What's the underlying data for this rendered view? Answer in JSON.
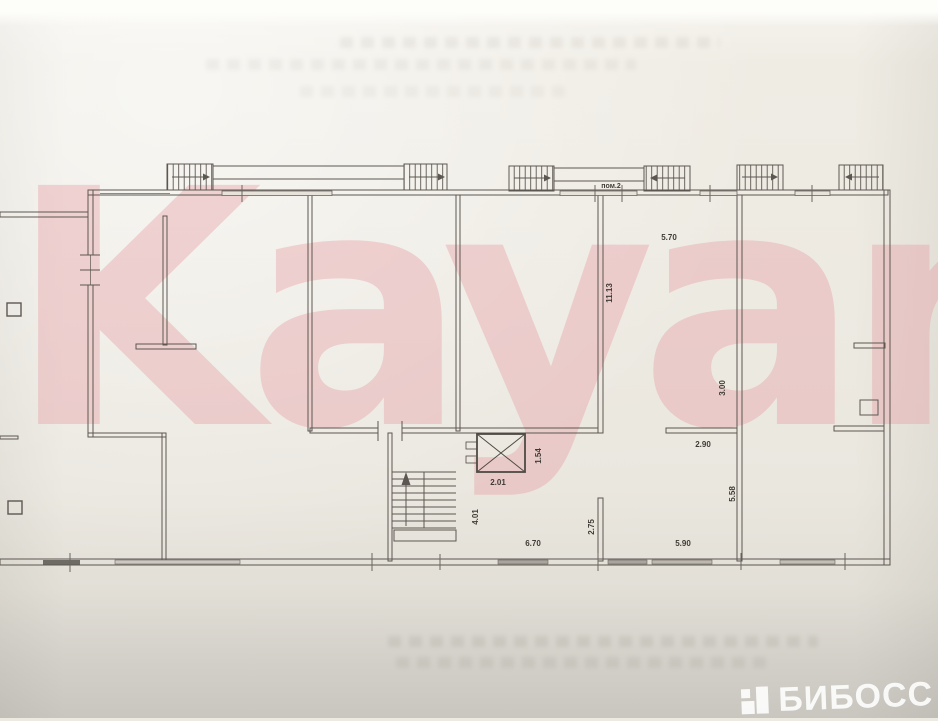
{
  "watermark": {
    "text": "Kayan"
  },
  "brand": {
    "name": "БИБОСС"
  },
  "plan": {
    "room_label": "пом.2",
    "dimensions": [
      {
        "text": "5.70"
      },
      {
        "text": "11.13"
      },
      {
        "text": "3.00"
      },
      {
        "text": "2.90"
      },
      {
        "text": "5.58"
      },
      {
        "text": "1.54"
      },
      {
        "text": "2.01"
      },
      {
        "text": "4.01"
      },
      {
        "text": "6.70"
      },
      {
        "text": "2.75"
      },
      {
        "text": "5.90"
      }
    ],
    "colors": {
      "line": "#5d5751",
      "paper": "#edeae2",
      "watermark_pink": "#e6a0a4",
      "glazing_dark": "#6e6a64"
    }
  }
}
